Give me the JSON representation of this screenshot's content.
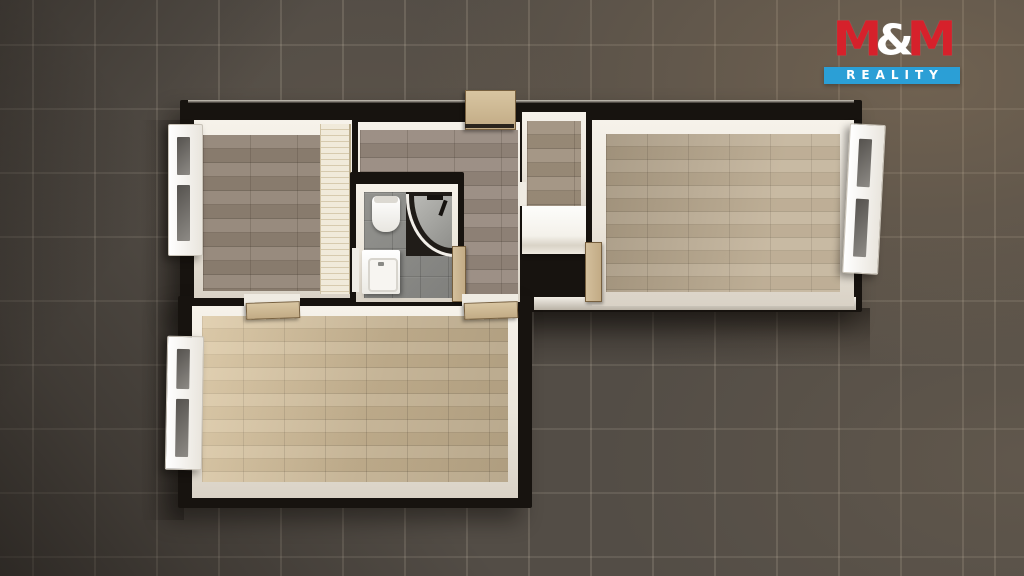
{
  "scene": {
    "description": "Top-down 3D rendered floor plan of an apartment standing on a dark tiled floor, lit warmly from the upper right",
    "regions": [
      "bedroom-left",
      "hallway",
      "bathroom",
      "closet",
      "living-room-right",
      "room-bottom"
    ],
    "fixtures": [
      "wardrobe",
      "toilet",
      "corner-shower",
      "washbasin",
      "white-cabinet",
      "entrance-door",
      "interior-doors",
      "windows"
    ]
  },
  "logo": {
    "m1": "M",
    "amp": "&",
    "m2": "M",
    "line2": "REALITY",
    "red": "#d6212b",
    "blue": "#2b9fd6",
    "text_color": "#ffffff"
  },
  "colors": {
    "background_tile": "#534d46",
    "grout": "#8d8374",
    "wall_top": "#17130f",
    "wall_inner_white": "#f6f2ea",
    "wood_gray": "#8e8071",
    "wood_light": "#b7a68c",
    "wood_warm": "#d3c09e",
    "bathroom_tile": "#8b8b88",
    "wardrobe_cream": "#e9dfc6",
    "door_wood": "#cdb894",
    "shadow": "#100c09"
  }
}
